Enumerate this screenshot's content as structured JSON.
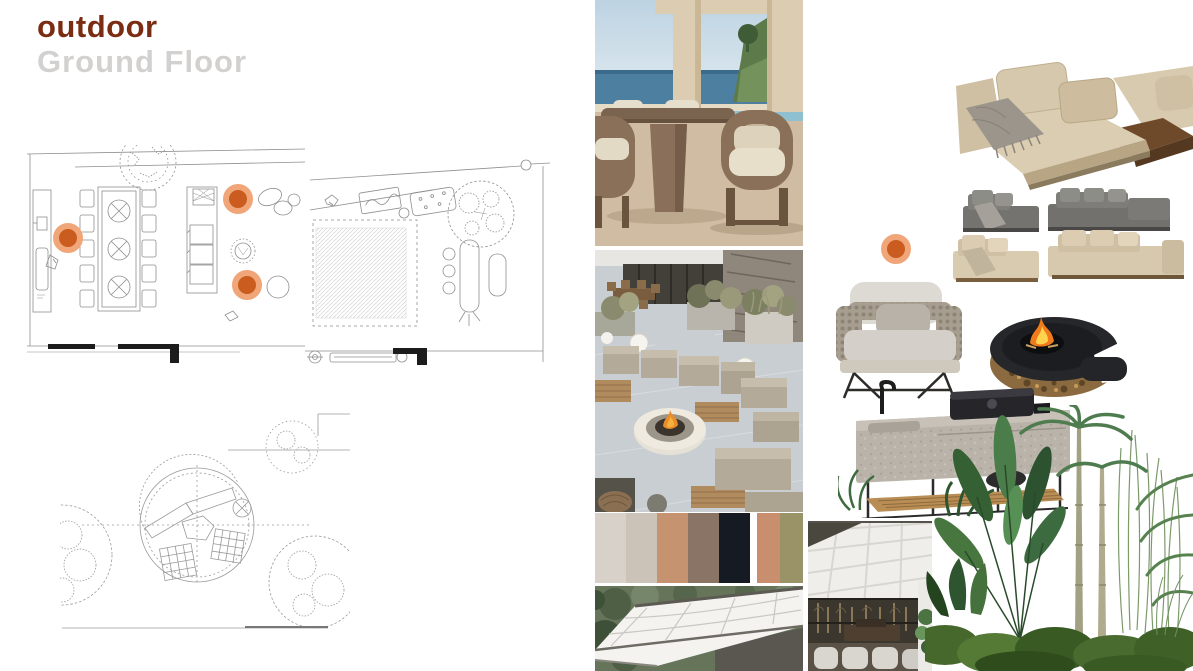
{
  "header": {
    "title": "outdoor",
    "subtitle": "Ground Floor"
  },
  "colors": {
    "title": "#7a2d12",
    "subtitle": "#d2d1cf",
    "plan_stroke": "#8f8f8f",
    "marker_inner": "#c95c1e",
    "marker_ring": "#f0a678"
  },
  "palette": {
    "group1": [
      "#d8d1c9",
      "#cbc3b8",
      "#c69370",
      "#8a7465",
      "#151a23"
    ],
    "group2": [
      "#c98e6e",
      "#9a9368"
    ]
  },
  "markers": [
    {
      "x": 68,
      "y": 238,
      "d": 30
    },
    {
      "x": 238,
      "y": 199,
      "d": 30
    },
    {
      "x": 247,
      "y": 285,
      "d": 30
    },
    {
      "x": 896,
      "y": 249,
      "d": 30
    }
  ],
  "figures": {
    "plan_terrace_dining": "floor-plan-outdoor-dining-terrace",
    "plan_lawn_pool": "floor-plan-lawn-and-planters",
    "plan_round_lounge": "floor-plan-circular-sunken-lounge",
    "photo_dining": "photo-outdoor-dining-ocean-view",
    "photo_terrace": "photo-terrace-lounge-fire-pit",
    "photo_pergola": "photo-retractable-pergola-canopy",
    "photo_canopy_interior": "photo-canopy-dining-interior",
    "render_sofas": "render-modular-outdoor-sofas",
    "render_armchair": "render-woven-armchair",
    "render_firepit": "render-spiral-wood-fire-pit",
    "render_kitchen": "render-stone-outdoor-kitchen",
    "render_plants": "render-tropical-plants"
  }
}
